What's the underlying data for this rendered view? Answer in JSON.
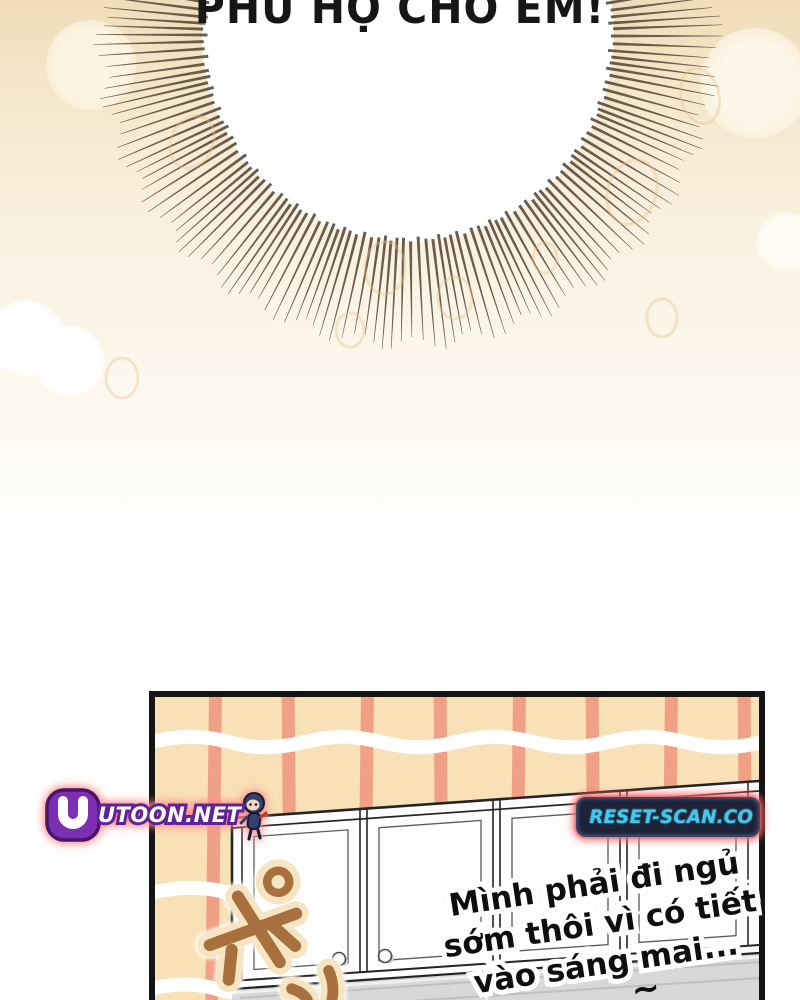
{
  "comic": {
    "top_speech": "PHÙ HỘ CHO EM!",
    "bottom_speech": {
      "line1": "Mình phải đi ngủ",
      "line2": "sớm thôi vì có tiết",
      "line3": "vào sáng mai..."
    },
    "squiggle": "~",
    "sfx_glyph": "ポ",
    "watermarks": {
      "left": "UTOON.NET",
      "right": "RESET-SCAN.CO"
    },
    "colors": {
      "background_top": "#F0DDBA",
      "burst_line": "#5D4F3E",
      "speech_bubble": "#FFFFFF",
      "wallpaper": "#F8E1B6",
      "wallpaper_stripe": "#F0A185",
      "cabinet": "#FDFDFD",
      "under_cabinet_gray": "#D8D8D8",
      "sfx_fill": "#A8703C",
      "sfx_outline": "#F6E5C2",
      "utoon_purple": "#7C2FB0",
      "reset_badge_bg": "#1E2338",
      "reset_badge_text": "#3FC9EE",
      "watermark_glow": "#FF8A8A",
      "text_ink": "#0E0E0E"
    },
    "sunburst": {
      "cx": 408,
      "cy": 36,
      "r_inner": 203,
      "r_outer": 308,
      "count": 190
    },
    "stripes": {
      "xs": [
        52,
        128,
        204,
        280,
        356,
        432,
        508,
        584
      ],
      "width": 13
    }
  }
}
